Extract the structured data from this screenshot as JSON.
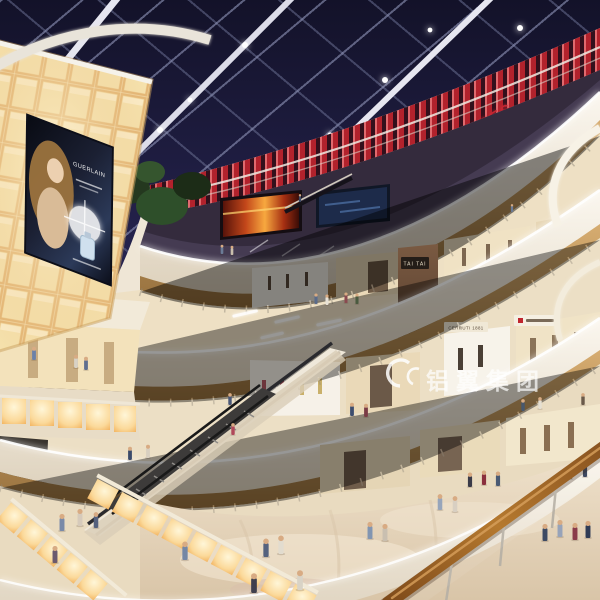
{
  "scene": {
    "description": "Multi-level shopping mall atrium interior rendering with skylight, curved balconies, escalators and shoppers"
  },
  "texts": {
    "theatre": "THEATRES",
    "watermark": "铝翼集团",
    "poster_brand": "GUERLAIN",
    "sign_tai_tai_upper": "TAI TAI",
    "sign_tai_tai_lower": "TAI TAI",
    "sign_cerruti": "CERRUTI 1881"
  },
  "colors": {
    "skyTop": "#131229",
    "skyMid": "#272450",
    "beam": "#e6e6f0",
    "slatRed": "#b2222c",
    "theatreText": "#c42531",
    "fascia": "#f5efe3",
    "wood": "#c09a62",
    "woodDark": "#8a6436",
    "panelWarm": "#fbeec6",
    "panelEdge": "#e5b878",
    "floor": "#e7d8c2",
    "glowRail": "#f6b45c",
    "handrail": "#a06a2c",
    "watermark": "#ffffff"
  },
  "people": [
    {
      "x": 316,
      "y": 296,
      "h": 8,
      "c": "#5a6b8a"
    },
    {
      "x": 327,
      "y": 297,
      "h": 8,
      "c": "#e8e2d6"
    },
    {
      "x": 346,
      "y": 295,
      "h": 8,
      "c": "#8a4a50"
    },
    {
      "x": 357,
      "y": 296,
      "h": 8,
      "c": "#4a5a3f"
    },
    {
      "x": 222,
      "y": 247,
      "h": 7,
      "c": "#6b7b97"
    },
    {
      "x": 232,
      "y": 248,
      "h": 7,
      "c": "#c9bead"
    },
    {
      "x": 300,
      "y": 196,
      "h": 6,
      "c": "#3f4a66"
    },
    {
      "x": 512,
      "y": 206,
      "h": 6,
      "c": "#6b7b95"
    },
    {
      "x": 352,
      "y": 406,
      "h": 10,
      "c": "#3e4e6e"
    },
    {
      "x": 366,
      "y": 407,
      "h": 10,
      "c": "#7a3b45"
    },
    {
      "x": 523,
      "y": 402,
      "h": 9,
      "c": "#48586e"
    },
    {
      "x": 540,
      "y": 400,
      "h": 9,
      "c": "#e5dfd2"
    },
    {
      "x": 583,
      "y": 396,
      "h": 9,
      "c": "#6a5a4a"
    },
    {
      "x": 34,
      "y": 350,
      "h": 10,
      "c": "#6b81a8"
    },
    {
      "x": 76,
      "y": 358,
      "h": 10,
      "c": "#d8d2c6"
    },
    {
      "x": 86,
      "y": 360,
      "h": 10,
      "c": "#5f6f8f"
    },
    {
      "x": 230,
      "y": 396,
      "h": 9,
      "c": "#4a5878"
    },
    {
      "x": 233,
      "y": 426,
      "h": 9,
      "c": "#b0485a"
    },
    {
      "x": 130,
      "y": 450,
      "h": 10,
      "c": "#3a4a6a"
    },
    {
      "x": 148,
      "y": 448,
      "h": 10,
      "c": "#d8cfc0"
    },
    {
      "x": 62,
      "y": 518,
      "h": 13,
      "c": "#7a8aa8"
    },
    {
      "x": 80,
      "y": 513,
      "h": 13,
      "c": "#d6cabb"
    },
    {
      "x": 96,
      "y": 516,
      "h": 12,
      "c": "#55617d"
    },
    {
      "x": 55,
      "y": 550,
      "h": 13,
      "c": "#6b5a6e"
    },
    {
      "x": 266,
      "y": 543,
      "h": 14,
      "c": "#55627e"
    },
    {
      "x": 281,
      "y": 540,
      "h": 14,
      "c": "#e2dccf"
    },
    {
      "x": 254,
      "y": 578,
      "h": 15,
      "c": "#3f3f4d"
    },
    {
      "x": 300,
      "y": 575,
      "h": 15,
      "c": "#d9d3c6"
    },
    {
      "x": 185,
      "y": 546,
      "h": 14,
      "c": "#7487a5"
    },
    {
      "x": 370,
      "y": 526,
      "h": 13,
      "c": "#8195b1"
    },
    {
      "x": 385,
      "y": 528,
      "h": 13,
      "c": "#c9bfb0"
    },
    {
      "x": 545,
      "y": 528,
      "h": 13,
      "c": "#3d4a63"
    },
    {
      "x": 560,
      "y": 524,
      "h": 13,
      "c": "#97a3b9"
    },
    {
      "x": 575,
      "y": 527,
      "h": 13,
      "c": "#8a3b4a"
    },
    {
      "x": 588,
      "y": 525,
      "h": 13,
      "c": "#2f3b55"
    },
    {
      "x": 470,
      "y": 476,
      "h": 11,
      "c": "#3a3a48"
    },
    {
      "x": 484,
      "y": 474,
      "h": 11,
      "c": "#8a2f3d"
    },
    {
      "x": 498,
      "y": 475,
      "h": 11,
      "c": "#4a5a74"
    },
    {
      "x": 570,
      "y": 468,
      "h": 11,
      "c": "#5b4a3a"
    },
    {
      "x": 585,
      "y": 466,
      "h": 11,
      "c": "#2f3b55"
    },
    {
      "x": 440,
      "y": 498,
      "h": 12,
      "c": "#97a5bb"
    },
    {
      "x": 455,
      "y": 500,
      "h": 12,
      "c": "#d8cfc2"
    }
  ]
}
